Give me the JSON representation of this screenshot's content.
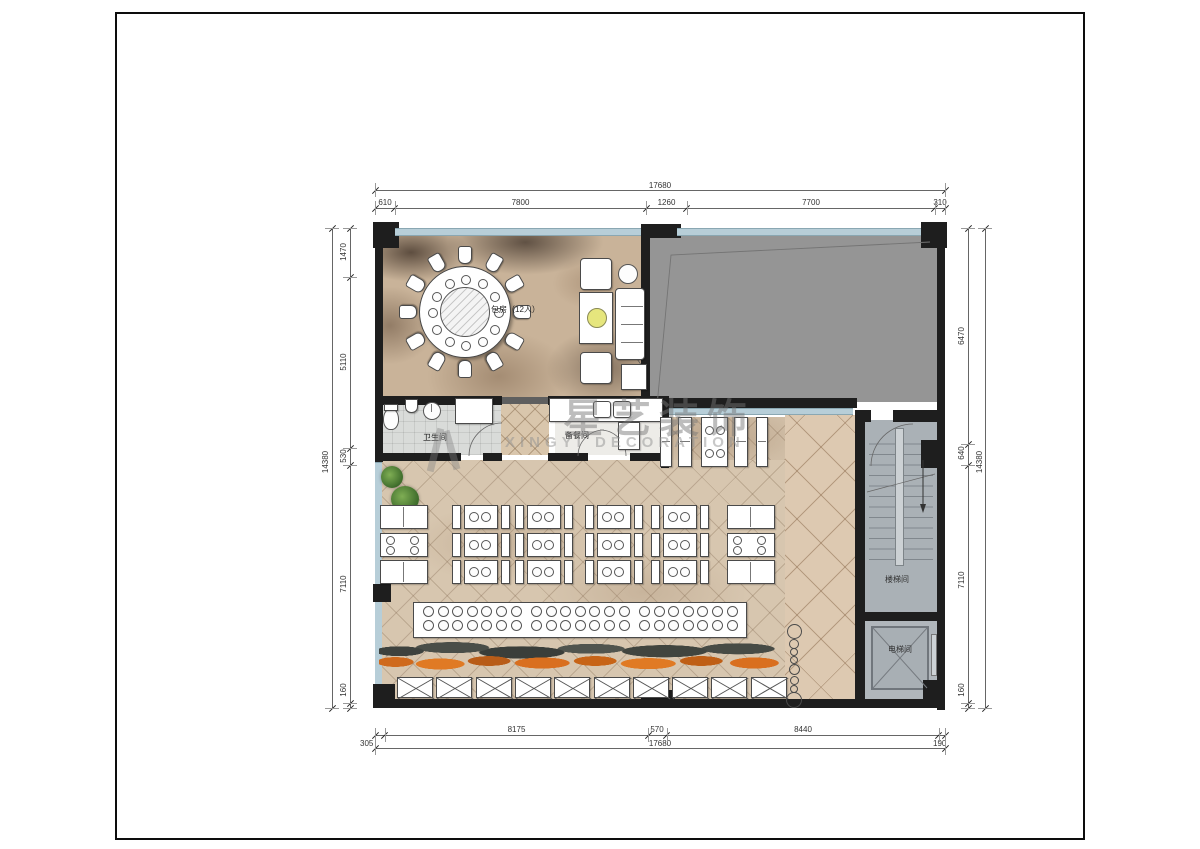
{
  "watermark": {
    "cn": "星艺装饰",
    "en": "XINGYI DECORATION"
  },
  "rooms": {
    "private": "包房（12人）",
    "bathroom": "卫生间",
    "prep": "备餐间",
    "stair": "楼梯间",
    "elevator": "电梯间"
  },
  "dims": {
    "top": {
      "total": "17680",
      "segments": [
        "610",
        "7800",
        "1260",
        "7700",
        "310"
      ]
    },
    "bottom": {
      "total": "17680",
      "segments": [
        "305",
        "8175",
        "570",
        "8440",
        "190"
      ]
    },
    "left": {
      "total": "14380",
      "segments": [
        "1470",
        "5110",
        "530",
        "7110",
        "160"
      ]
    },
    "right": {
      "total": "14380",
      "segments": [
        "6470",
        "640",
        "7110",
        "160"
      ]
    }
  },
  "colors": {
    "wall": "#1e1e1e",
    "glazing": "#b7ced8",
    "gray_room": "#959595",
    "dining_floor": "#d7c6af",
    "walkway_floor": "#ddc9b1",
    "stair_floor": "#aab1b6",
    "plant_orange": "#cf6a1d"
  }
}
